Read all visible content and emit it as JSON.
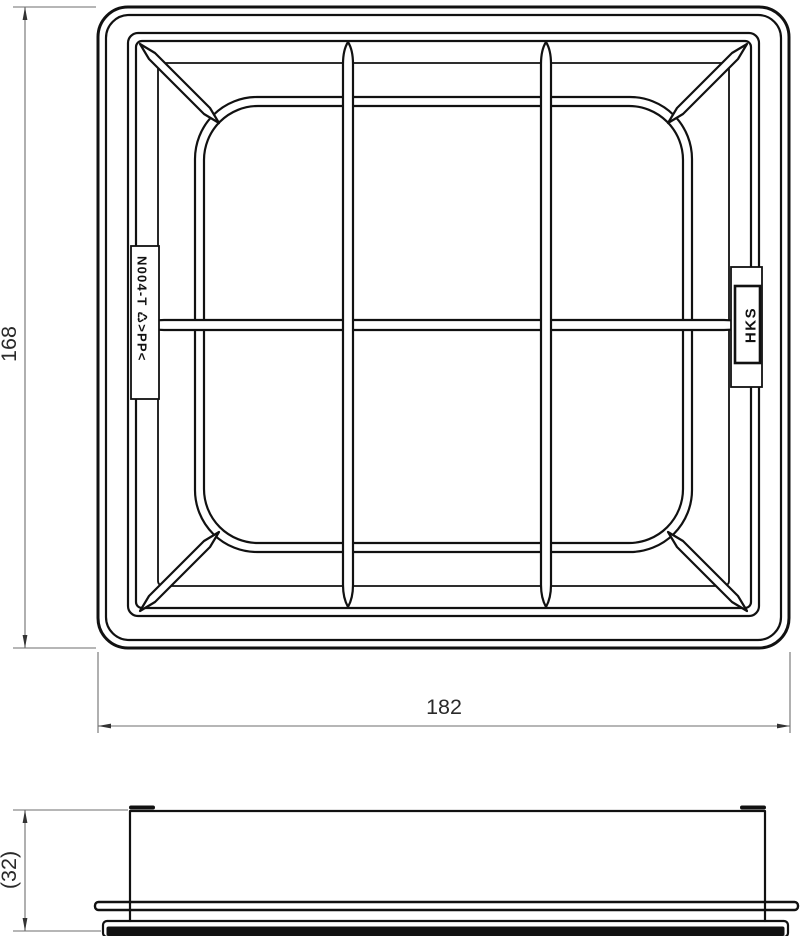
{
  "top_view": {
    "height_dim": "168",
    "width_dim": "182",
    "part_label": "N004-T ♺>PP<",
    "brand_label": "HKS"
  },
  "side_view": {
    "height_dim": "(32)"
  },
  "colors": {
    "background": "#ffffff",
    "part_line": "#111111",
    "dim_line": "#6e6e6e",
    "dim_text": "#2a2a2a"
  }
}
